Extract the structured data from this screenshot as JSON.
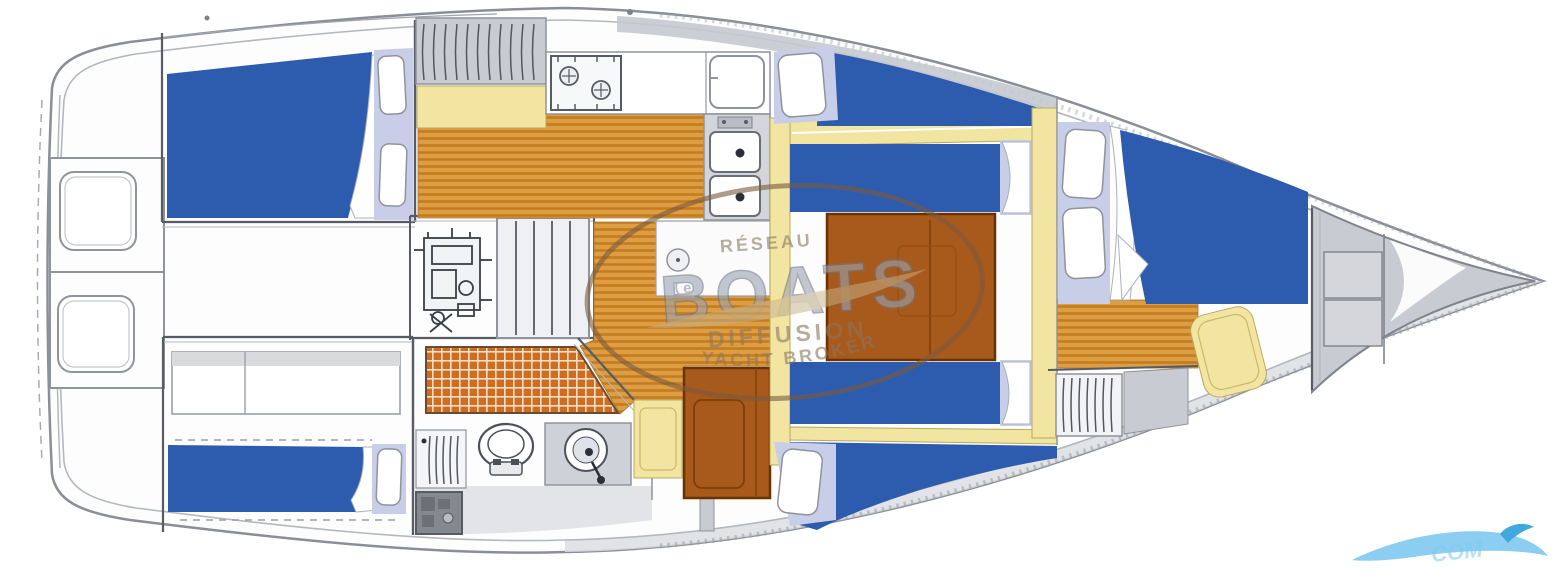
{
  "page": {
    "type": "sailing-yacht-interior-layout-plan",
    "orientation": "bow-right"
  },
  "watermark": {
    "network_label": "RÉSEAU",
    "brand": "BOATS",
    "brand_mark": "e",
    "line_diffusion": "DIFFUSION",
    "line_broker": "YACHT BROKER"
  },
  "corner_watermark": {
    "text": "COM"
  },
  "icons": {
    "toilet": "toilet-icon",
    "washbasin": "washbasin-icon",
    "double_sink": "double-sink-icon",
    "stove": "stove-icon",
    "fridge": "fridge-icon",
    "engine": "engine-icon",
    "steps": "companionway-steps-icon",
    "shower_grate": "shower-grate-icon",
    "wave": "wave-swoosh-icon"
  },
  "colors": {
    "cushion_blue": "#2d5bad",
    "pillow_lavender": "#c9cee8",
    "wood_base": "#dd9d42",
    "wood_stripe": "#c57c1f",
    "grate_base": "#cf6c20",
    "grate_line": "#f3e0c8",
    "counter_yellow": "#f2e5a2",
    "table_brown": "#a8591c",
    "table_border": "#6b3200",
    "locker_gray": "#c9cbd2",
    "floor_gray": "#e3e4e8",
    "hull_stroke": "#8a8e97",
    "wall_stroke": "#565b64",
    "watermark_brown": "#7a5a3e",
    "watermark_text": "#8a7860",
    "brand_fill": "#9aa3b2",
    "brand_stroke": "#6e7684",
    "swoosh_tan": "#c6b188",
    "wave_blue": "#7ec9ef",
    "wave_deep": "#3fa8dc"
  }
}
